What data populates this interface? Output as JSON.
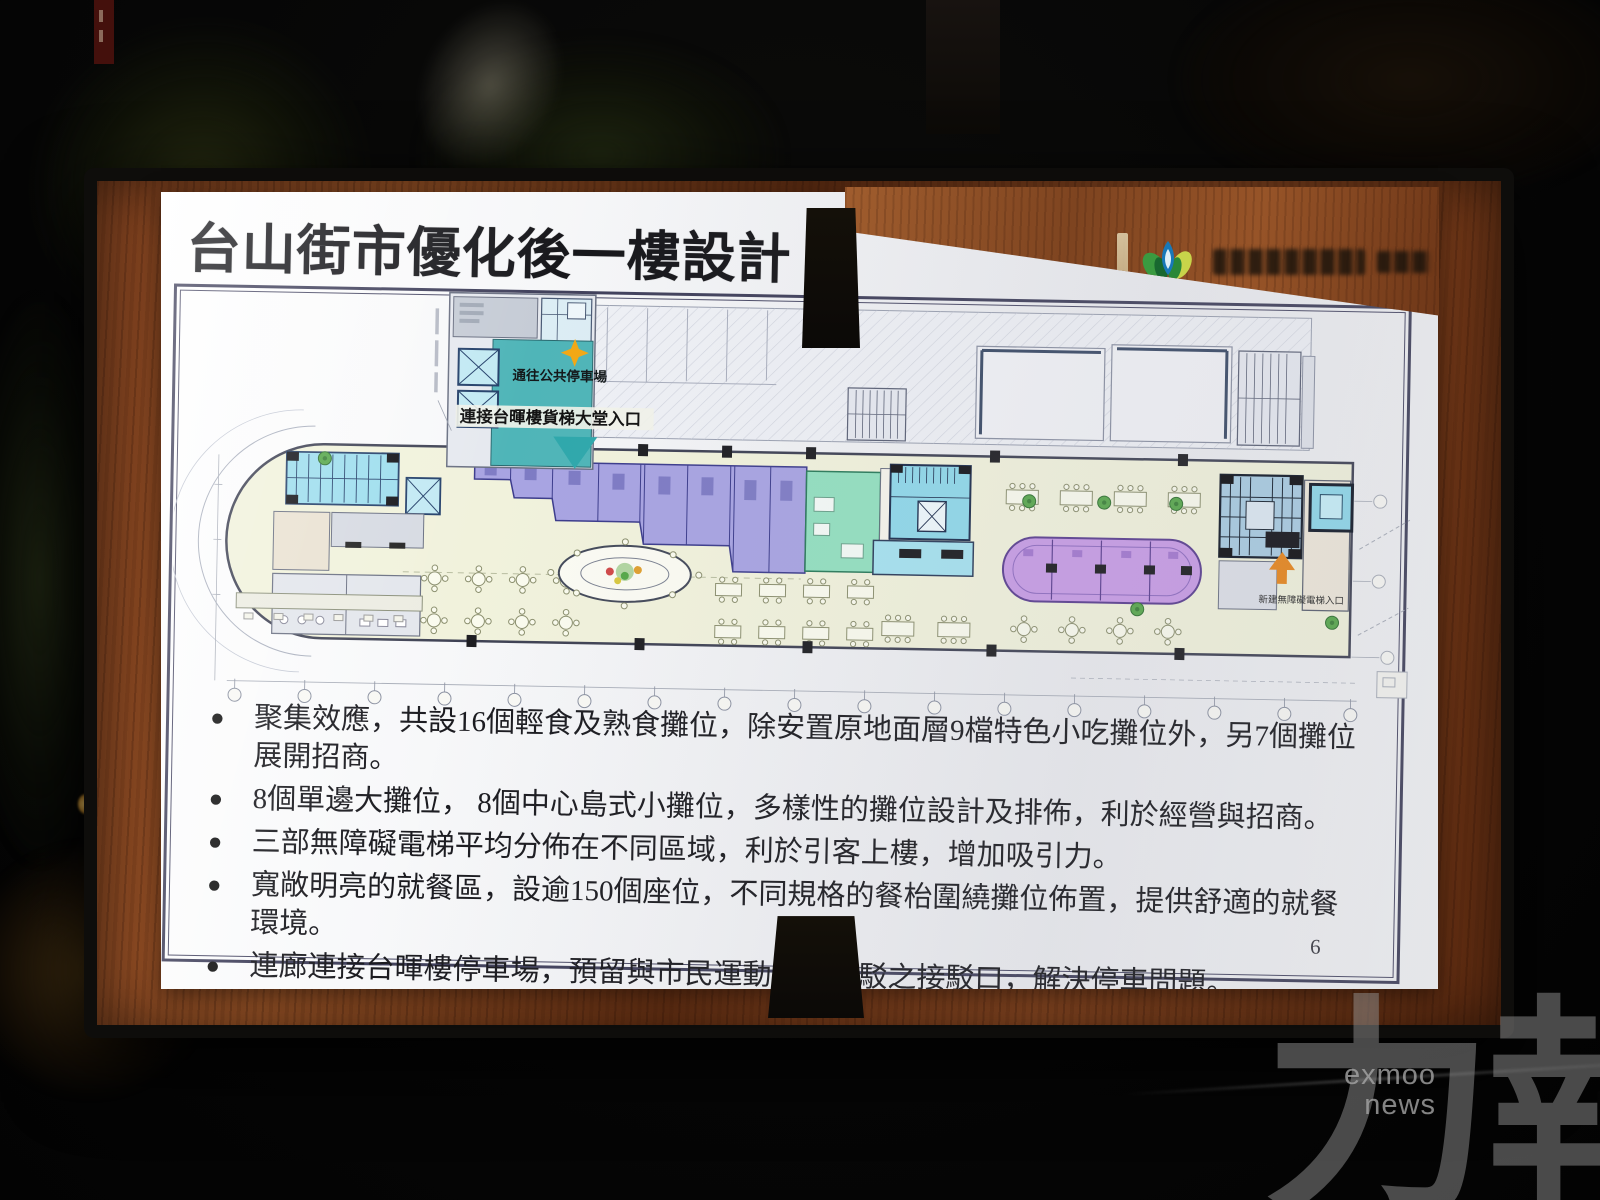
{
  "slide": {
    "title": "台山街市優化後一樓設計",
    "page_number": "6",
    "bullets": [
      "聚集效應，共設16個輕食及熟食攤位，除安置原地面層9檔特色小吃攤位外，另7個攤位展開招商。",
      "8個單邊大攤位， 8個中心島式小攤位，多樣性的攤位設計及排佈，利於經營與招商。",
      "三部無障礙電梯平均分佈在不同區域，利於引客上樓，增加吸引力。",
      "寬敞明亮的就餐區，設逾150個座位，不同規格的餐枱圍繞攤位佈置，提供舒適的就餐環境。",
      "連廊連接台暉樓停車場，預留與市民運動公園接駁之接駁口，解決停車問題。",
      "增設哺乳室，創建友善環境。"
    ],
    "plan_labels": {
      "to_public_parking": "通往公共停車場",
      "freight_lobby_entrance": "連接台暉樓貨梯大堂入口",
      "new_accessible_lift_entrance": "新建無障礙電梯入口"
    }
  },
  "watermark": {
    "cn": "力報",
    "en_line1": "exmoo",
    "en_line2": "news"
  },
  "colors": {
    "stall_purple": "#a8a4e2",
    "island_purple": "#c89ce6",
    "mint_green": "#93e0c0",
    "stair_cyan": "#8fd8ea",
    "corridor_teal": "#4fb5b8",
    "dining_floor": "#f1f2dc",
    "arrow_orange": "#e8871c",
    "wood_frame": "#8a4a24"
  }
}
